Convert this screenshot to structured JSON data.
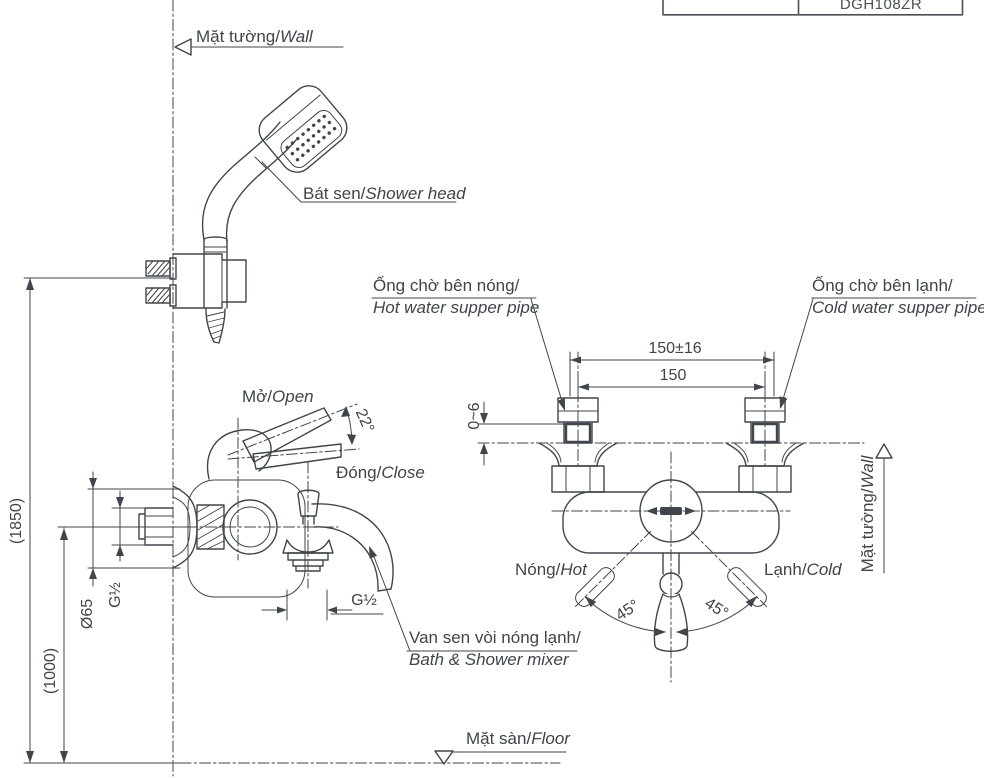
{
  "drawing": {
    "product_code": "DGH108ZR",
    "labels": {
      "wall_top": {
        "vi": "Mặt tường/",
        "en": "Wall"
      },
      "shower_head": {
        "vi": "Bát sen/",
        "en": "Shower head"
      },
      "hot_pipe": {
        "vi": "Ống chờ bên nóng/",
        "en": "Hot water supper pipe"
      },
      "cold_pipe": {
        "vi": "Ống chờ bên lạnh/",
        "en": "Cold water supper pipe"
      },
      "open": {
        "vi": "Mở/",
        "en": "Open"
      },
      "close": {
        "vi": "Đóng/",
        "en": "Close"
      },
      "hot_side": {
        "vi": "Nóng/",
        "en": "Hot"
      },
      "cold_side": {
        "vi": "Lạnh/",
        "en": "Cold"
      },
      "wall_right": {
        "vi": "Mặt tường/",
        "en": "Wall"
      },
      "floor": {
        "vi": "Mặt sàn/",
        "en": "Floor"
      },
      "mixer": {
        "vi": "Van sen vòi nóng lạnh/",
        "en": "Bath & Shower mixer"
      }
    },
    "dimensions": {
      "pipe_span_tolerance": "150±16",
      "pipe_span": "150",
      "wall_gap": "0~6",
      "open_angle": "22°",
      "handle_angle_left": "45°",
      "handle_angle_right": "45°",
      "shower_height": "(1850)",
      "mixer_height": "(1000)",
      "flange_diameter": "Ø65",
      "thread_side": "G½",
      "thread_bottom": "G½"
    },
    "colors": {
      "line": "#40464c",
      "background": "#ffffff"
    }
  }
}
